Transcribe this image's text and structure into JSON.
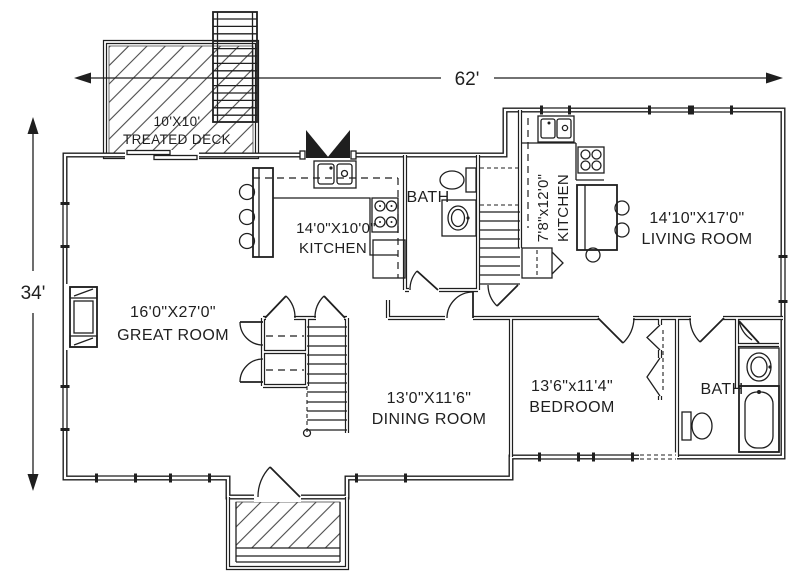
{
  "dimensions": {
    "width": "62'",
    "height": "34'"
  },
  "rooms": {
    "deck": {
      "size": "10'X10'",
      "name": "TREATED DECK"
    },
    "kitchen": {
      "size": "14'0\"X10'0\"",
      "name": "KITCHEN"
    },
    "bath": {
      "name": "BATH"
    },
    "kitchen2": {
      "size": "7'8\"x12'0\"",
      "name": "KITCHEN"
    },
    "living": {
      "size": "14'10\"X17'0\"",
      "name": "LIVING ROOM"
    },
    "great": {
      "size": "16'0\"X27'0\"",
      "name": "GREAT ROOM"
    },
    "dining": {
      "size": "13'0\"X11'6\"",
      "name": "DINING ROOM"
    },
    "bedroom": {
      "size": "13'6\"x11'4\"",
      "name": "BEDROOM"
    },
    "bath2": {
      "name": "BATH"
    }
  },
  "colors": {
    "ink": "#1f1f1f",
    "background": "#ffffff",
    "hatch": "#4a4a4a"
  }
}
